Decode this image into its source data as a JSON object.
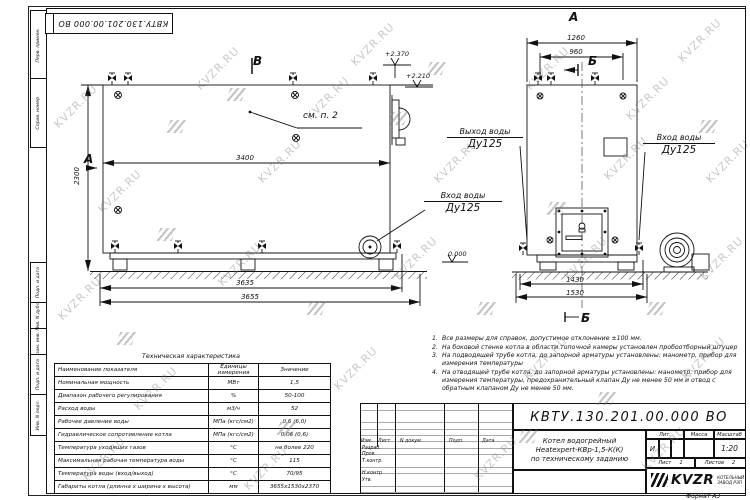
{
  "watermark": {
    "text": "KVZR.RU"
  },
  "stamp_top": {
    "number": "КВТУ.130.201.00.000  ВО"
  },
  "frame_left": {
    "labels": [
      "Перв. примен.",
      "Справ. номер",
      "Подп. и дата",
      "Инв. N дубл.",
      "Взам. инв. N",
      "Подп. и дата",
      "Инв. N подл."
    ]
  },
  "side_view": {
    "view_letter_top": "В",
    "view_letter_left": "А",
    "callout": "см. п. 2",
    "dim_width": "3400",
    "dim_height": "2300",
    "dim_base1": "3635",
    "dim_base2": "3655",
    "elev_1": "+2.370",
    "elev_2": "+2.210",
    "elev_zero": "0.000",
    "inlet_label_line1": "Вход воды",
    "inlet_label_line2": "Ду125"
  },
  "front_view": {
    "title": "А",
    "section_letter_top": "Б",
    "section_letter_bottom": "Б",
    "dim_top1": "1260",
    "dim_top2": "960",
    "dim_bottom1": "1430",
    "dim_bottom2": "1530",
    "outlet_label_line1": "Выход воды",
    "outlet_label_line2": "Ду125",
    "inlet_label_line1": "Вход воды",
    "inlet_label_line2": "Ду125"
  },
  "notes": [
    {
      "num": "1.",
      "text": "Все размеры для справок, допустимое отклонение  ±100 мм."
    },
    {
      "num": "2.",
      "text": "На боковой стенке котла в области топочной камеры установлен пробоотборный штуцер"
    },
    {
      "num": "3.",
      "text": "На  подводящей трубе котла, до запорной арматуры установлены:  манометр, прибор для измерения температуры"
    },
    {
      "num": "4.",
      "text": "На отводящей трубе котла, до запорной арматуры установлены: манометр, прибор для измерения температуры, предохранительный клапан  Ду не менее  50 мм и отвод с обратным клапаном  Ду не менее  50 мм."
    }
  ],
  "spec_table": {
    "title": "Техническая характеристика",
    "headers": [
      "Наименование показателя",
      "Единицы измерения",
      "Значение"
    ],
    "rows": [
      [
        "Номинальная мощность",
        "МВт",
        "1,5"
      ],
      [
        "Диапазон рабочего регулирования",
        "%",
        "50-100"
      ],
      [
        "Расход воды",
        "м3/ч",
        "52"
      ],
      [
        "Рабочее давление воды",
        "МПа (кгс/см2)",
        "0,6 (6,0)"
      ],
      [
        "Гидравлическое сопротивление котла",
        "МПа (кгс/см2)",
        "0,06 (0,6)"
      ],
      [
        "Температура уходящих газов",
        "°С",
        "не более 220"
      ],
      [
        "Максимальная рабочая температура воды",
        "°С",
        "115"
      ],
      [
        "Температура воды (вход/выход)",
        "°С",
        "70/95"
      ],
      [
        "Габариты котла (длинна х ширина х высота)",
        "мм",
        "3655х1530х2370"
      ]
    ]
  },
  "title_block": {
    "number": "КВТУ.130.201.00.000  ВО",
    "doc_name_line1": "Котел водогрейный",
    "doc_name_line2": "Heatexpert-КВр-1,5-К(К)",
    "doc_name_line3": "по техническому заданию",
    "col_headers": [
      "Изм.",
      "Лист",
      "N докум.",
      "Подп.",
      "Дата"
    ],
    "row_labels": [
      "Разраб.",
      "Пров.",
      "Т.контр.",
      "",
      "Н.контр.",
      "Утв."
    ],
    "lit_header": "Лит.",
    "lit_value": "И",
    "mass_header": "Масса",
    "scale_header": "Масштаб",
    "scale_value": "1:20",
    "sheet_label": "Лист",
    "sheet_value": "1",
    "sheets_label": "Листов",
    "sheets_value": "2",
    "company_logo": "KVZR",
    "company_line1": "КОТЕЛЬНЫЙ",
    "company_line2": "ЗАВОД РЭП",
    "format_label": "Формат   А3"
  }
}
